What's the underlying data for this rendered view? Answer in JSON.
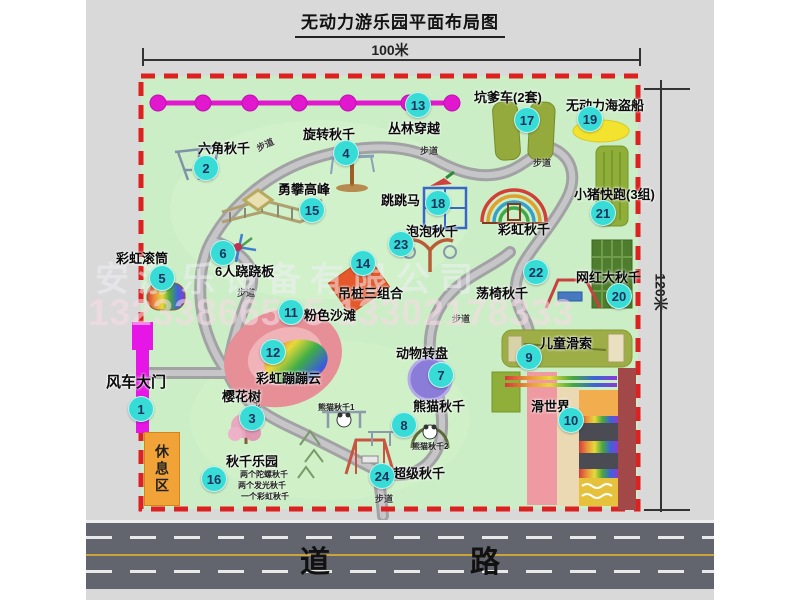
{
  "title": "无动力游乐园平面布局图",
  "dimensions": {
    "width": "100米",
    "height": "120米"
  },
  "watermark": {
    "company": "安游乐设备有限公司",
    "phones": "13233866535 13302178333"
  },
  "road_label": "道　路",
  "path_label": "步道",
  "rest_area_label": "休息区",
  "rainbow_swing_label": "彩虹秋千",
  "attractions": [
    {
      "num": "1",
      "label": "风车大门"
    },
    {
      "num": "2",
      "label": "六角秋千"
    },
    {
      "num": "3",
      "label": "樱花树"
    },
    {
      "num": "4",
      "label": "旋转秋千"
    },
    {
      "num": "5",
      "label": "彩虹滚筒"
    },
    {
      "num": "6",
      "label": "6人跷跷板"
    },
    {
      "num": "7",
      "label": "动物转盘"
    },
    {
      "num": "8",
      "label": "熊猫秋千",
      "sub1": "熊猫秋千1",
      "sub2": "熊猫秋千2"
    },
    {
      "num": "9",
      "label": "儿童滑索"
    },
    {
      "num": "10",
      "label": "滑世界"
    },
    {
      "num": "11",
      "label": "粉色沙滩"
    },
    {
      "num": "12",
      "label": "彩虹蹦蹦云"
    },
    {
      "num": "13",
      "label": "丛林穿越"
    },
    {
      "num": "14",
      "label": "吊桩三组合"
    },
    {
      "num": "15",
      "label": "勇攀高峰"
    },
    {
      "num": "16",
      "label": "秋千乐园",
      "note1": "两个陀螺秋千",
      "note2": "两个发光秋千",
      "note3": "一个彩虹秋千"
    },
    {
      "num": "17",
      "label": "坑爹车(2套)"
    },
    {
      "num": "18",
      "label": "跳跳马"
    },
    {
      "num": "19",
      "label": "无动力海盗船"
    },
    {
      "num": "20",
      "label": "网红大秋千"
    },
    {
      "num": "21",
      "label": "小猪快跑(3组)"
    },
    {
      "num": "22",
      "label": "荡椅秋千"
    },
    {
      "num": "23",
      "label": "泡泡秋千"
    },
    {
      "num": "24",
      "label": "超级秋千"
    }
  ]
}
